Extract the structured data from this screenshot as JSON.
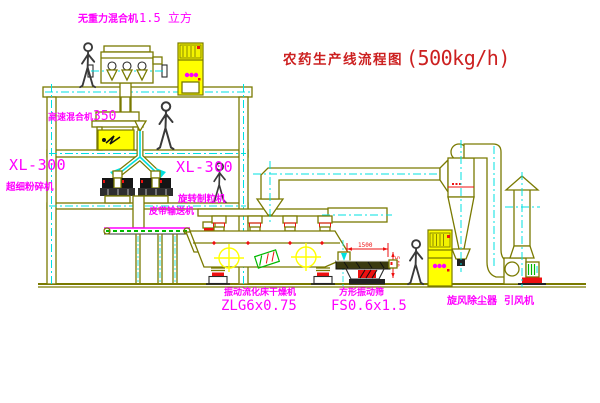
{
  "title": {
    "text": "农药生产线流程图",
    "capacity": "(500kg/h)"
  },
  "equipment_labels": {
    "gravity_mixer": {
      "name": "无重力混合机",
      "spec": "1.5 立方"
    },
    "high_speed_mixer": {
      "name": "高速混合机",
      "spec": "350"
    },
    "pulverizer": {
      "model": "XL-300",
      "name": "超细粉碎机"
    },
    "granulator": {
      "model": "XL-300",
      "name": "旋转制粒机"
    },
    "belt_conveyor": {
      "name": "皮带输送机"
    },
    "dryer": {
      "name": "振动流化床干燥机",
      "model": "ZLG6x0.75"
    },
    "sifter": {
      "name": "方形振动筛",
      "model": "FS0.6x1.5"
    },
    "cyclone": {
      "name": "旋风除尘器"
    },
    "fan": {
      "name": "引风机"
    }
  },
  "dimensions": {
    "sifter_length": "1500",
    "sifter_height": "540"
  },
  "colors": {
    "line": "#7a7a00",
    "centerline": "#00e0e0",
    "label": "#ff00ff",
    "title": "#cc2020",
    "accent_red": "#ee1111",
    "cabinet_yellow": "#ffff00",
    "accent_green": "#00b800"
  }
}
